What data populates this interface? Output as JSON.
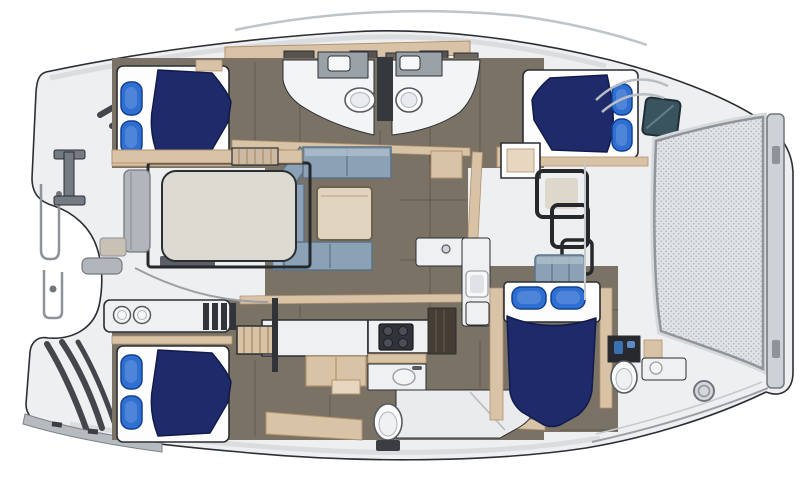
{
  "meta": {
    "title": "Catamaran yacht interior floor plan, top view",
    "diagram_type": "boat-floor-plan"
  },
  "palette": {
    "outline": "#2b2e33",
    "deck": "#edeff1",
    "deck_shadow": "#d2d6d9",
    "deck_line": "#bfc4c8",
    "floor": "#7b7266",
    "floor_dark": "#645c51",
    "bed_navy": "#1f2a6a",
    "bed_navy_dark": "#121a4a",
    "pillow_blue": "#2f6fd2",
    "pillow_dark": "#114090",
    "pillow_light": "#6d9be0",
    "sheet_white": "#fdfdfd",
    "tan": "#d9c3a7",
    "tan_dark": "#b2926e",
    "tan_light": "#e7d7c0",
    "sofa": "#8ba1b5",
    "sofa_dark": "#5c7388",
    "sofa_light": "#aebfcc",
    "table_tan": "#e0d4bf",
    "counter_white": "#eef0f1",
    "gray_furn": "#9aa1a7",
    "gray_dark": "#565b60",
    "appliance_dark": "#31353b",
    "wood_dark": "#453c33",
    "teal_window": "#3a545f",
    "mesh_bg": "#e0e3e6",
    "mesh_dot": "#a9afb5",
    "bar_fill": "#cdd2d6",
    "pad": "#dcdad1",
    "bench_gray": "#b0b6bb"
  },
  "areas": {
    "hull": {
      "label": "Hull and deck outline"
    },
    "cabin_top_left": {
      "label": "Guest cabin with double berth (aft port)"
    },
    "cabin_bottom_left": {
      "label": "Guest cabin with double berth (aft starboard)"
    },
    "cabin_top_right": {
      "label": "Guest cabin with double berth (forward port)"
    },
    "cabin_mid_right": {
      "label": "Cabin with double berth (forward starboard)"
    },
    "heads": {
      "label": "Twin heads with toilets and basins"
    },
    "salon": {
      "label": "Salon with U-shaped sofa and table"
    },
    "galley": {
      "label": "Galley with stove and sinks"
    },
    "shower_room": {
      "label": "Bathroom with toilet and shower"
    },
    "cockpit": {
      "label": "Cockpit lounge pad"
    },
    "trampoline": {
      "label": "Trampoline mesh"
    },
    "transom": {
      "label": "Transom steps and rails"
    }
  },
  "inventory": {
    "double_beds": 4,
    "pillows": 8,
    "toilets": 4,
    "basins": 7,
    "stove_burners": 4,
    "sofas": 1,
    "tables": 1,
    "trampoline_panels": 1,
    "deck_hatches": 1,
    "windows": 1,
    "cleats": 1
  }
}
